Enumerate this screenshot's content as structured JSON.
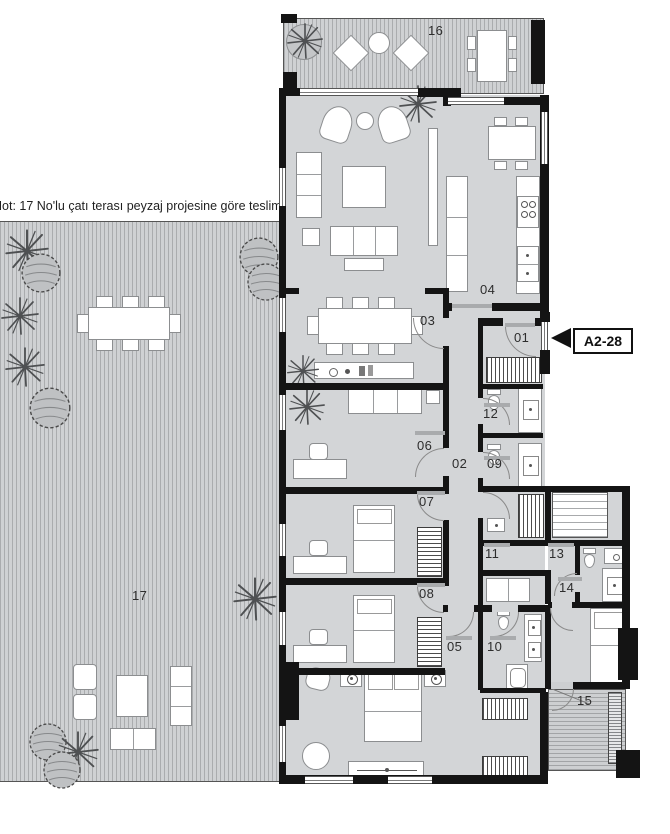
{
  "note": "Not: 17 No'lu çatı terası peyzaj projesine göre teslim edilecektir.",
  "tag": "A2-28",
  "rooms": {
    "r01": "01",
    "r02": "02",
    "r03": "03",
    "r04": "04",
    "r05": "05",
    "r06": "06",
    "r07": "07",
    "r08": "08",
    "r09": "09",
    "r10": "10",
    "r11": "11",
    "r12": "12",
    "r13": "13",
    "r14": "14",
    "r15": "15",
    "r16": "16",
    "r17": "17"
  },
  "colors": {
    "wall": "#141414",
    "floor": "#d3d5d7",
    "terrace": "#cfd1d3"
  }
}
